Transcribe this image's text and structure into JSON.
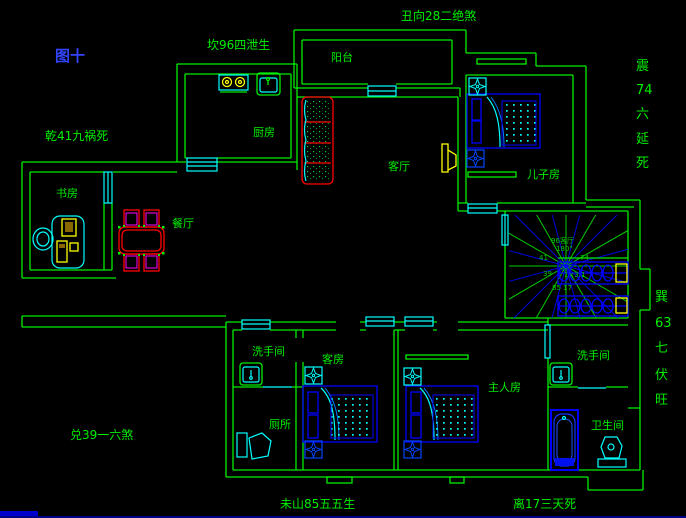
{
  "figure_label": "图十",
  "compass": {
    "top": "坎96四泄生",
    "top_right": "丑向28二绝煞",
    "upper_left": "乾41九祸死",
    "right_upper": [
      "震",
      "74",
      "六",
      "延",
      "死"
    ],
    "right_lower": [
      "巽",
      "63",
      "七",
      "伏",
      "旺"
    ],
    "lower_left": "兑39一六煞",
    "bottom_left": "未山85五五生",
    "bottom_right": "离17三天死"
  },
  "rooms": {
    "balcony": "阳台",
    "kitchen": "厨房",
    "living_room": "客厅",
    "sons_room": "儿子房",
    "study": "书房",
    "dining": "餐厅",
    "washroom_left": "洗手间",
    "guest_room": "客房",
    "master_room": "主人房",
    "toilet": "厕所",
    "washroom_right": "洗手间",
    "bathroom": "卫生间"
  },
  "stairs_annotation": {
    "line1": "96客厅",
    "line2": "180°",
    "num_nw": "41",
    "num_ne": "74",
    "num_w": "39",
    "num_center": "1×3.1",
    "num_s": "85 17"
  },
  "colors": {
    "background": "#000000",
    "walls": "#00ee00",
    "openings": "#00ffff",
    "furniture_blue": "#0000ff",
    "accent_red": "#ff0000",
    "accent_magenta": "#ff00ff",
    "accent_yellow": "#ffff00",
    "figure_label_blue": "#3344ff"
  }
}
